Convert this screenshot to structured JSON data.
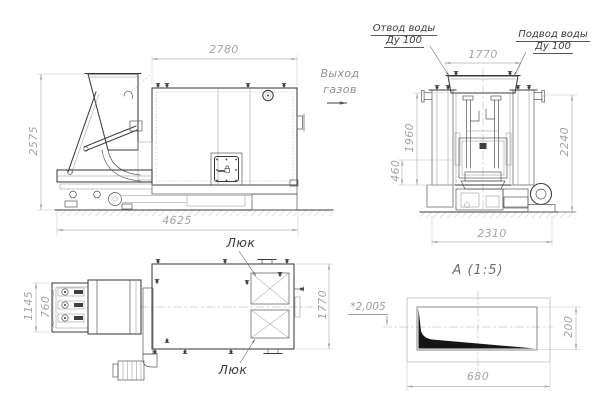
{
  "drawing": {
    "side_view": {
      "dim_boiler_width": "2780",
      "dim_total_height": "2575",
      "dim_total_length": "4625"
    },
    "gas_outlet": {
      "line1": "Выход",
      "line2": "газов"
    },
    "end_view": {
      "water_outlet": {
        "line1": "Отвод воды",
        "line2": "Ду 100"
      },
      "water_inlet": {
        "line1": "Подвод воды",
        "line2": "Ду 100"
      },
      "dim_top_width": "1770",
      "dim_furnace_height": "1960",
      "dim_base_height": "460",
      "dim_total_height": "2240",
      "dim_foundation_width": "2310"
    },
    "plan_view": {
      "hatch_top_label": "Люк",
      "hatch_bottom_label": "Люк",
      "dim_feeder_width": "1145",
      "dim_feeder_inner_width": "760",
      "dim_body_width": "1770"
    },
    "detail_a": {
      "title": "А (1:5)",
      "dim_depth": "*2,005",
      "dim_height": "200",
      "dim_length": "680"
    }
  }
}
